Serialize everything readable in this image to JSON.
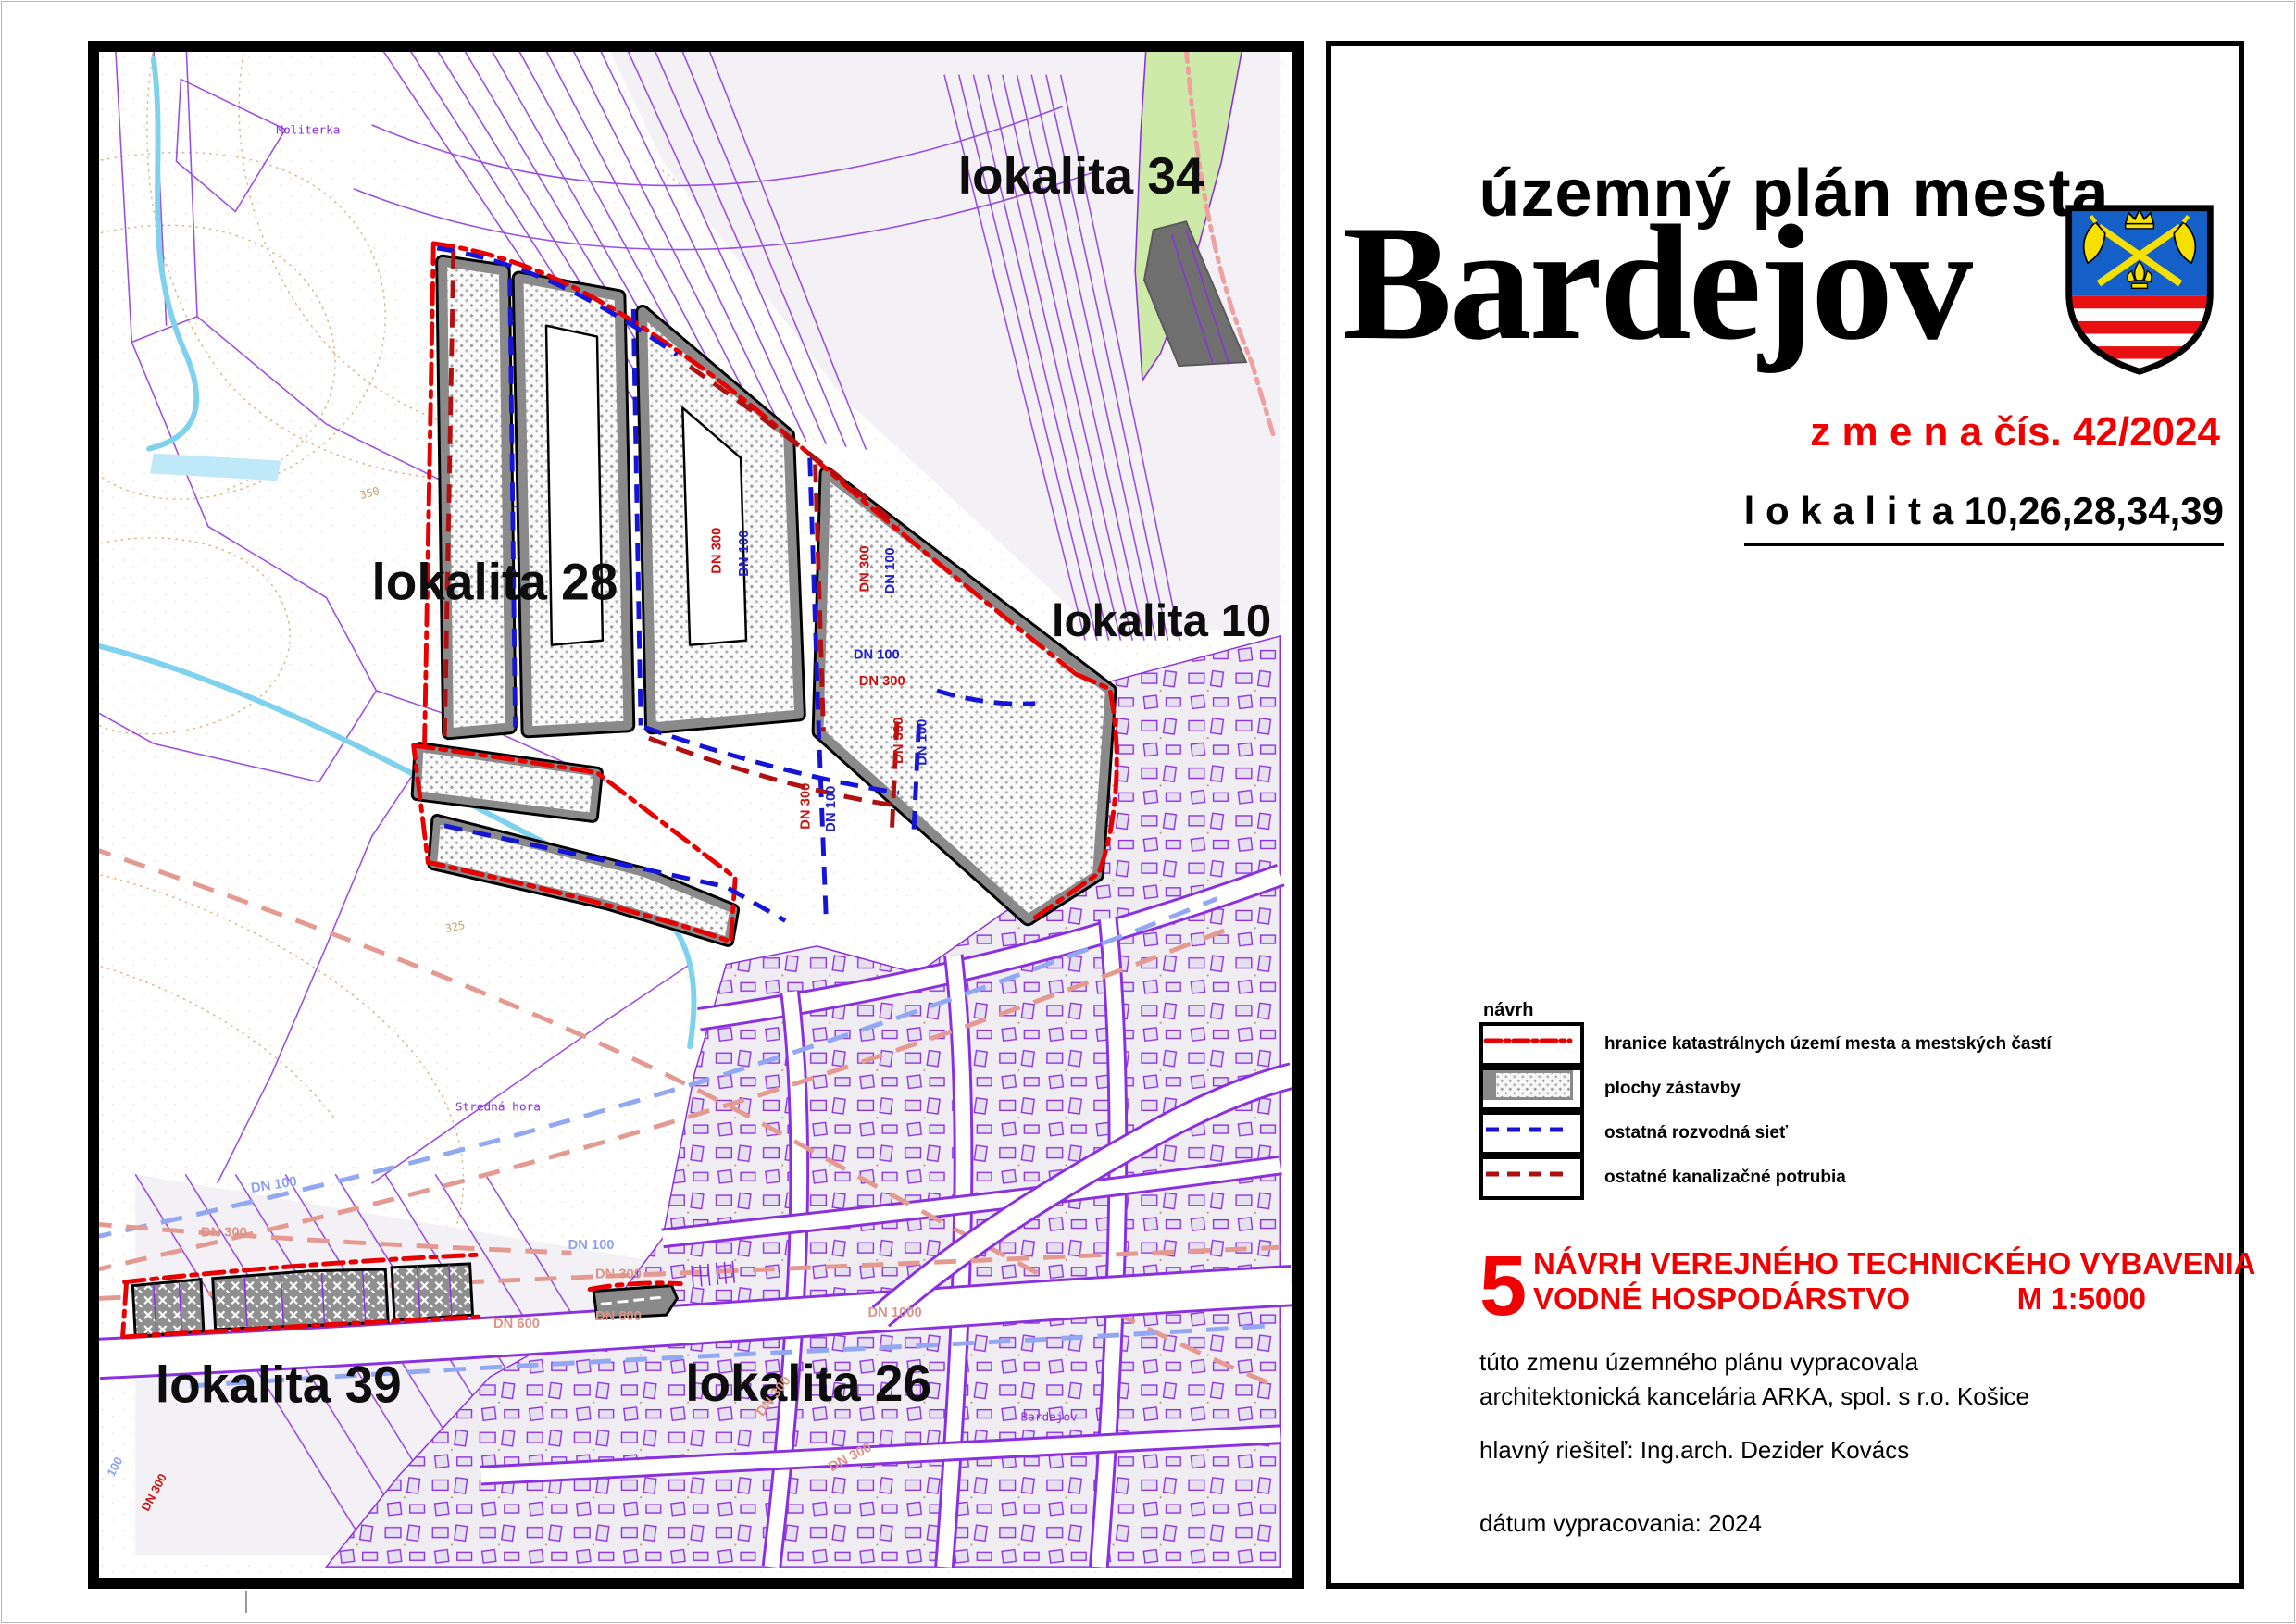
{
  "title_panel": {
    "supertitle": "územný plán mesta",
    "city": "Bardejov",
    "change_label": "z m e n a  čís. 42/2024",
    "localities_label": "l o k a l i t a  10,26,28,34,39",
    "legend": {
      "heading": "návrh",
      "items": [
        {
          "key": "boundary",
          "label": "hranice katastrálnych území mesta a mestských častí"
        },
        {
          "key": "built-area",
          "label": "plochy zástavby"
        },
        {
          "key": "water-network",
          "label": "ostatná rozvodná sieť"
        },
        {
          "key": "sewer-network",
          "label": "ostatné kanalizačné potrubia"
        }
      ]
    },
    "sheet": {
      "number": "5",
      "line1": "NÁVRH  VEREJNÉHO TECHNICKÉHO VYBAVENIA",
      "line2": "VODNÉ HOSPODÁRSTVO",
      "scale": "M 1:5000"
    },
    "credits": [
      "túto zmenu územného plánu vypracovala",
      "architektonická kancelária ARKA, spol. s r.o. Košice",
      "hlavný riešiteľ: Ing.arch. Dezider Kovács",
      "dátum vypracovania: 2024"
    ]
  },
  "map": {
    "locality_labels": {
      "l34": "lokalita 34",
      "l28": "lokalita 28",
      "l10": "lokalita 10",
      "l39": "lokalita 39",
      "l26": "lokalita 26"
    },
    "place_labels": {
      "moliterka": "Moliterka",
      "stredna_hora": "Stredná hora",
      "bardejov_road": "Bardejov"
    },
    "pipe_labels": {
      "dn100": "DN 100",
      "dn300": "DN 300",
      "dn600": "DN 600",
      "dn800": "DN 800",
      "dn1000": "DN 1000",
      "n100": "100"
    },
    "contour_labels": {
      "c350": "350",
      "c325": "325"
    }
  },
  "colors": {
    "accent_red": "#f00000",
    "boundary_red": "#e80000",
    "new_water_blue": "#1515d8",
    "new_sewer_red": "#b01010",
    "old_water_blue": "#92a8f2",
    "old_sewer_pink": "#e49a90",
    "parcel_purple": "#8a30e0",
    "shield_blue": "#1560c8",
    "shield_yellow": "#f5e000",
    "green_area": "#cdeaa8"
  }
}
